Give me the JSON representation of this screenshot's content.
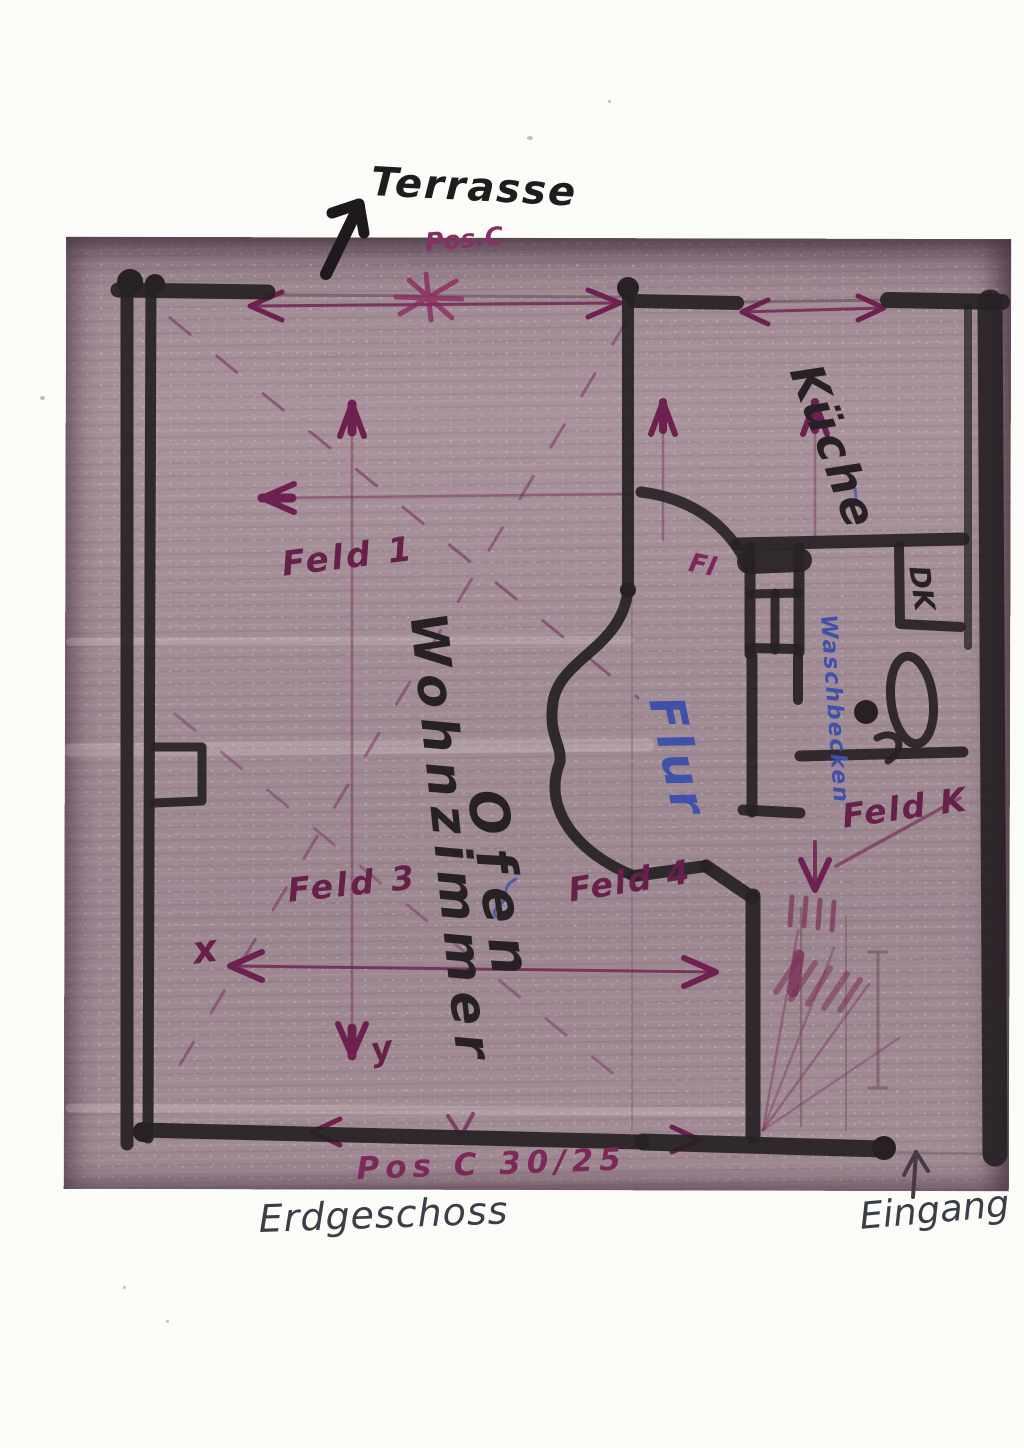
{
  "meta": {
    "description": "Scanned hand-drawn ground-floor plan with marker and pen annotations"
  },
  "colors": {
    "paper": "#fbfbf8",
    "scan_base": "#a18c95",
    "marker_black": "#272125",
    "ink_purple": "#6e2150",
    "pen_blue": "#3f51a8",
    "pen_dark": "#3a3e46"
  },
  "labels": {
    "terrasse": "Terrasse",
    "pos_top": "Pos.C",
    "kueche": "Küche",
    "feld_1": "Feld 1",
    "wohnzimmer": "Wohnzimmer",
    "ofen": "Ofen",
    "flur": "Flur",
    "fl_abbrev": "Fl",
    "waschbecken": "Waschbecken",
    "dk": "DK",
    "feld_3": "Feld 3",
    "feld_4": "Feld 4",
    "feld_k": "Feld K",
    "axis_x": "x",
    "axis_y": "y",
    "pos_bottom": "Pos C 30/25",
    "erdgeschoss": "Erdgeschoss",
    "eingang": "Eingang"
  }
}
